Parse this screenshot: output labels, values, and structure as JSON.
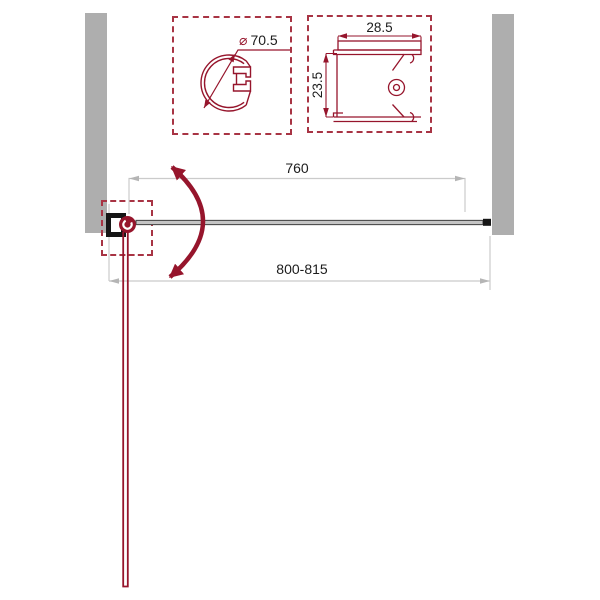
{
  "drawing": {
    "type": "shower-door-top-view-technical-drawing",
    "details": {
      "circle_profile": {
        "description": "hinge wall profile diameter detail",
        "diameter_symbol": "⌀",
        "diameter_value": "70.5"
      },
      "section_profile": {
        "description": "wall mounting profile cross-section detail",
        "width": "28.5",
        "depth": "23.5"
      }
    },
    "dimensions": {
      "glass_width": "760",
      "total_width": "800-815"
    },
    "colors": {
      "accent_maroon": "#96152C",
      "dashed_red": "#A83444",
      "wall_gray": "#AEAEAE",
      "dim_line_gray": "#CBCBCB",
      "dim_arrow_gray": "#B5B5B5",
      "text": "#1C1C1C",
      "glass_dark": "#4A4A4A",
      "bracket_black": "#161616"
    }
  }
}
